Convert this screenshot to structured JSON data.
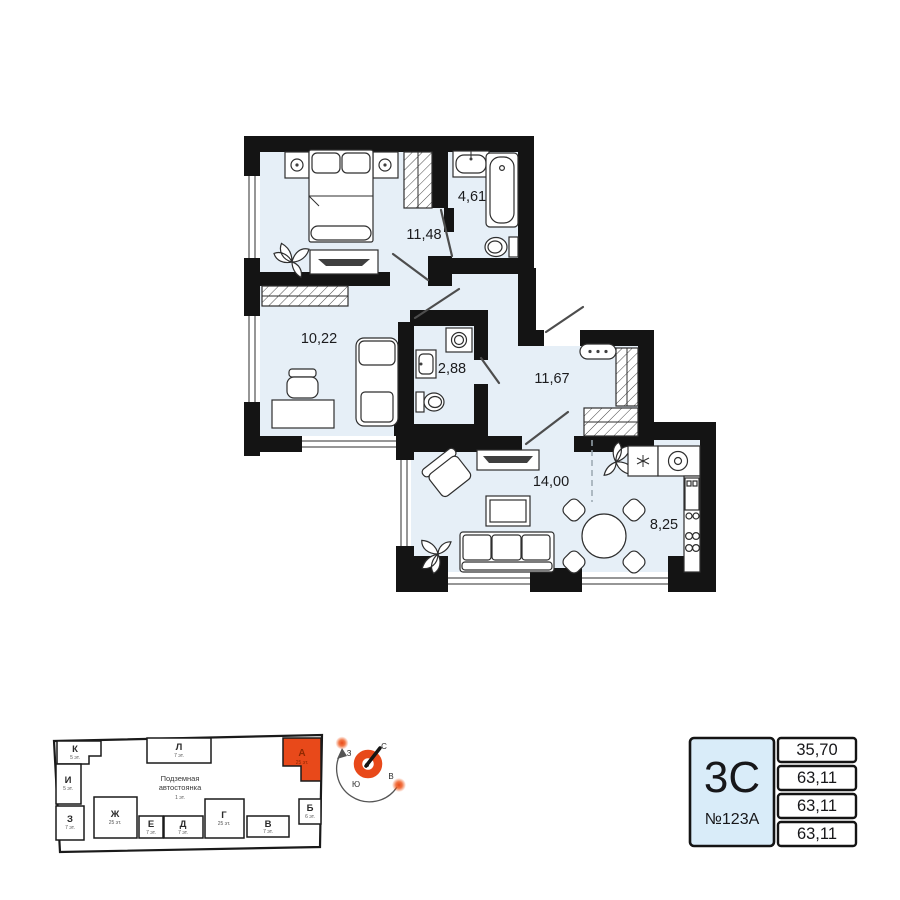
{
  "floor_plan": {
    "rooms": [
      {
        "name": "bedroom-1",
        "area": "11,48"
      },
      {
        "name": "bathroom",
        "area": "4,61"
      },
      {
        "name": "bedroom-2",
        "area": "10,22"
      },
      {
        "name": "wc",
        "area": "2,88"
      },
      {
        "name": "hallway",
        "area": "11,67"
      },
      {
        "name": "living-room",
        "area": "14,00"
      },
      {
        "name": "kitchen",
        "area": "8,25"
      }
    ]
  },
  "site_plan": {
    "parking_line1": "Подземная",
    "parking_line2": "автостоянка",
    "parking_floors": "1 эт.",
    "buildings": [
      {
        "label": "К",
        "floors": "5 эт."
      },
      {
        "label": "И",
        "floors": "5 эт."
      },
      {
        "label": "З",
        "floors": "7 эт."
      },
      {
        "label": "Ж",
        "floors": "25 эт."
      },
      {
        "label": "Е",
        "floors": "7 эт."
      },
      {
        "label": "Д",
        "floors": "7 эт."
      },
      {
        "label": "Г",
        "floors": "25 эт."
      },
      {
        "label": "В",
        "floors": "7 эт."
      },
      {
        "label": "Б",
        "floors": "6 эт."
      },
      {
        "label": "Л",
        "floors": "7 эт."
      },
      {
        "label": "А",
        "floors": "25 эт.",
        "highlighted": true
      }
    ],
    "compass": {
      "north": "С",
      "east": "В",
      "south": "Ю",
      "west": "З"
    }
  },
  "info_card": {
    "plan_type": "3С",
    "apartment_number": "№123А",
    "areas": [
      "35,70",
      "63,11",
      "63,11",
      "63,11"
    ]
  },
  "colors": {
    "accent_orange": "#e8491a",
    "room_fill": "#e6eff7",
    "card_fill": "#d9ecf9",
    "wall_black": "#141414"
  }
}
